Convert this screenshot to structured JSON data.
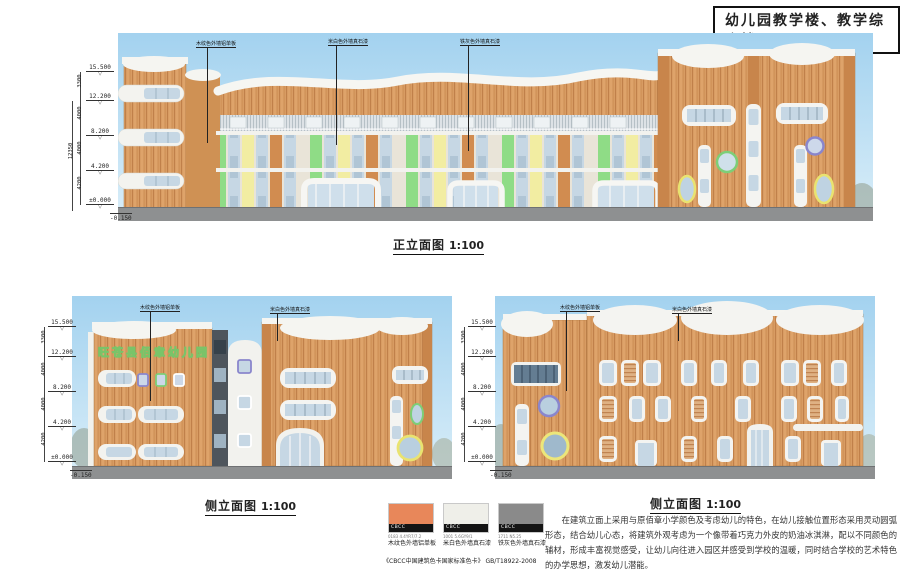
{
  "sheet": {
    "title": "幼儿园教学楼、教学综合楼"
  },
  "captions": {
    "front": {
      "label": "正立面图",
      "scale": "1:100"
    },
    "side_left": {
      "label": "侧立面图",
      "scale": "1:100"
    },
    "side_right": {
      "label": "侧立面图",
      "scale": "1:100"
    }
  },
  "dims": {
    "levels": [
      "15.500",
      "12.200",
      "8.200",
      "4.200",
      "±0.000",
      "-0.150"
    ],
    "segments": [
      "3300",
      "4000",
      "4000",
      "4200"
    ],
    "overall": "12350"
  },
  "elevations": {
    "front": {
      "callouts": [
        "木纹色外墙铝单板",
        "米白色外墙真石漆",
        "铁灰色外墙真石漆"
      ]
    },
    "side_left": {
      "callouts": [
        "木纹色外墙铝单板",
        "米白色外墙真石漆"
      ],
      "sign": "旺苍县佰章幼儿园"
    },
    "side_right": {
      "callouts": [
        "木纹色外墙铝单板",
        "米白色外墙真石漆"
      ]
    }
  },
  "legend": {
    "swatches": [
      {
        "brand": "CBCC",
        "code": "0183 4.4YR7/7.2",
        "caption": "木纹色外墙铝单板",
        "color": "#e8875a"
      },
      {
        "brand": "CBCC",
        "code": "1001 5.6GY9/1",
        "caption": "米白色外墙真石漆",
        "color": "#efefe9"
      },
      {
        "brand": "CBCC",
        "code": "1711 N5.25",
        "caption": "铁灰色外墙真石漆",
        "color": "#8a8a8a"
      }
    ],
    "standard": "《CBCC中国建筑色卡国家标准色卡》 GB/T18922-2008"
  },
  "description": {
    "text": "在建筑立面上采用与原佰章小学颜色及考虑幼儿的特色，在幼儿接触位置形态采用灵动圆弧形态，结合幼儿心态，将建筑外观考虑为一个像带着巧克力外皮的奶油冰淇淋，配以不同颜色的辅材，形成丰富视觉感受，让幼儿向往进入园区并感受到学校的温暖，同时结合学校的艺术特色的办学思想，激发幼儿潜能。"
  },
  "colors": {
    "sky": "#a3d2ef",
    "wood": "#d89c63",
    "ground": "#8e9091",
    "snow": "#f5f5f1",
    "glass": "#c6d7e4",
    "green_panel": "#8fdc86",
    "yellow_panel": "#f2eda2",
    "orange_panel": "#d18c50",
    "green_ring": "#7dce77",
    "purple_ring": "#8a86cc",
    "yellow_ring": "#e9e370"
  }
}
